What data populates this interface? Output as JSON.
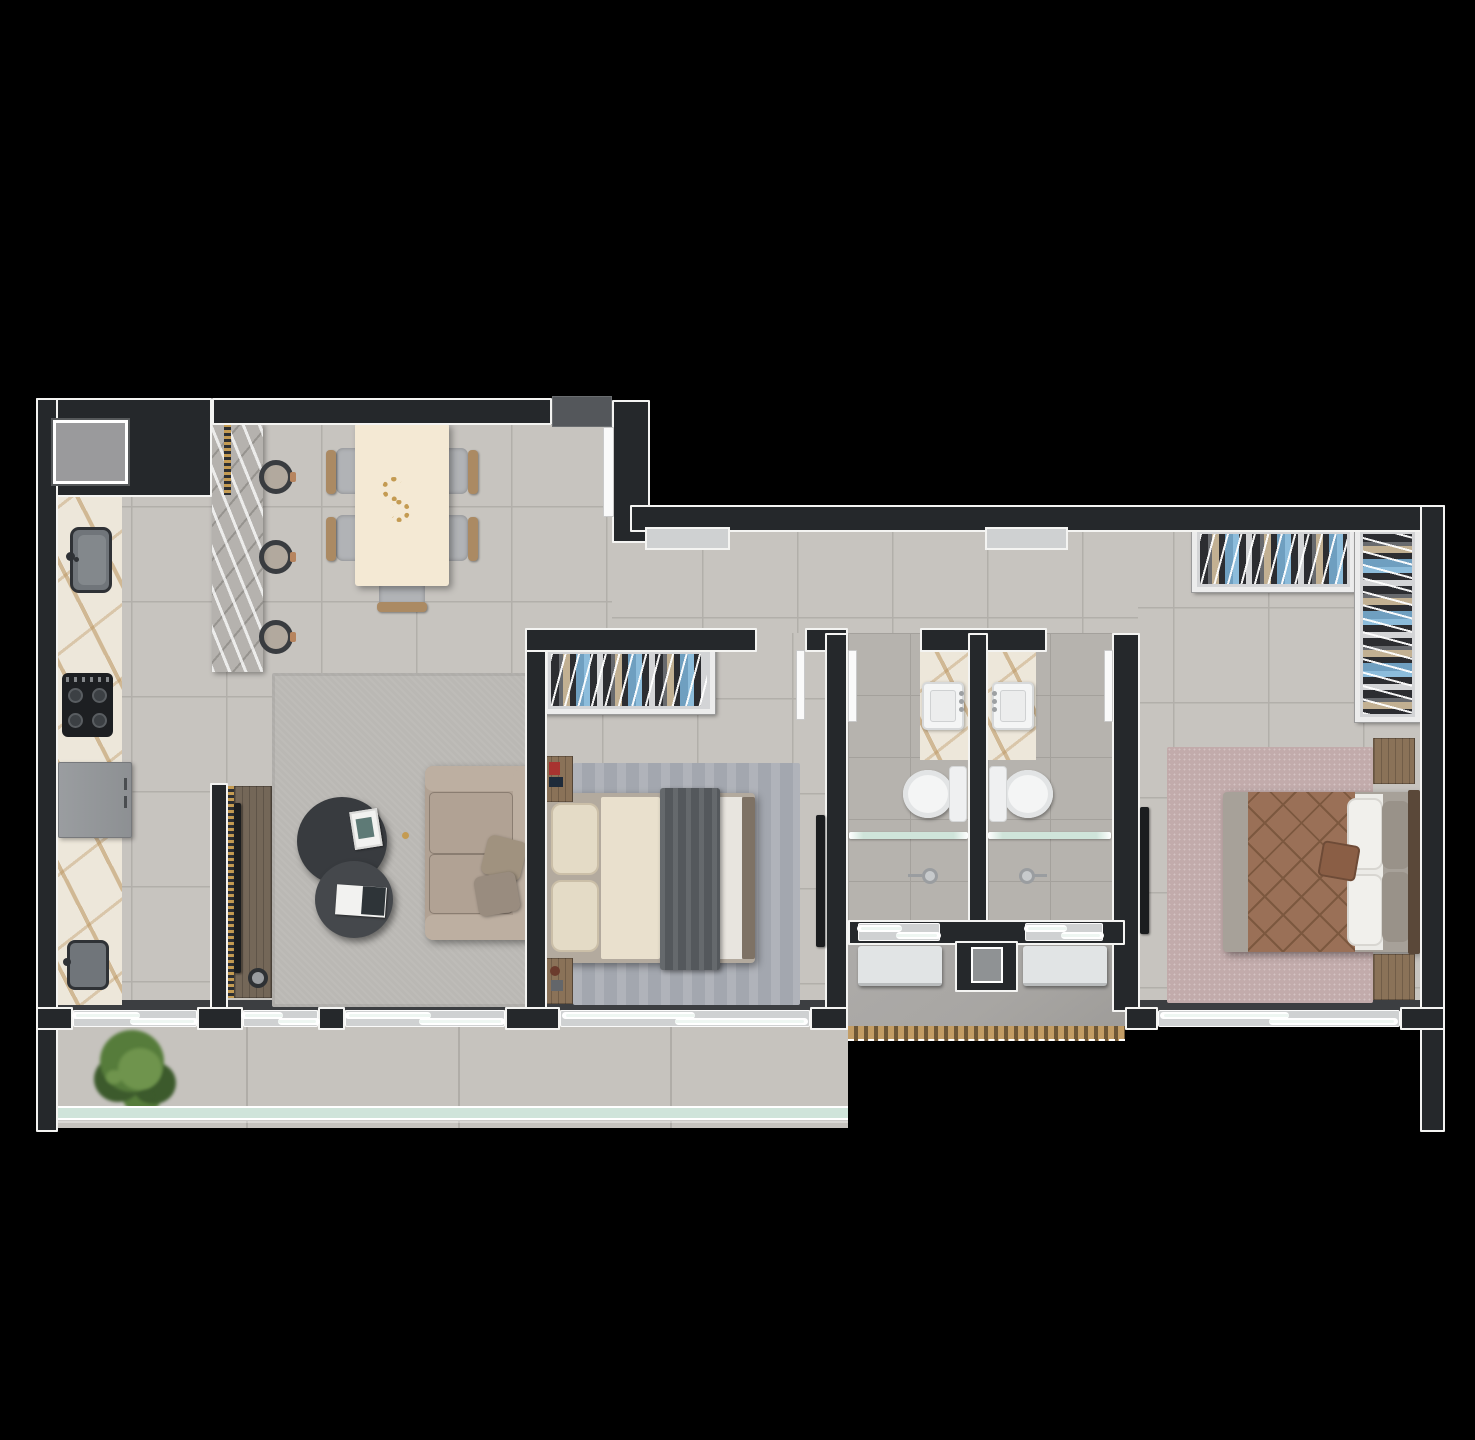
{
  "scene": {
    "type": "apartment-floor-plan-3d-render",
    "view": "top-down",
    "background": "#000000",
    "note": "photoreal furnished floor plan, no text labels visible"
  },
  "palette": {
    "bg": "#000000",
    "wall": "#25282b",
    "trim": "#f4f4f2",
    "floorMain": "#c7c4bf",
    "groutMain": "#b2afaa",
    "floorBath": "#b6b3ae",
    "groutBath": "#a4a19c",
    "floorService": "#a8a6a3",
    "floorBalcony": "#c6c3be",
    "groutBalcony": "#b0ada8",
    "track": "#3c3e41",
    "marbleCream": "#ede7da",
    "marbleGray": "#b5b2ae",
    "tableCream": "#f4e9d4",
    "woodMid": "#8a7258",
    "consoleWood": "#746758",
    "sofaBody": "#b1a294",
    "sofaArm": "#bdafa1",
    "sofaPillow": "#a0927f",
    "ctDark1": "#383b3f",
    "ctDark2": "#45484c",
    "rugLiving": "#bab8b4",
    "rugBed1": "#a3a7af",
    "rugBed2": "#c2abab",
    "sheetCream": "#e9e0cd",
    "pillowCream": "#e4dbc6",
    "blanketDark": "#54585c",
    "foldWhite": "#e8e5df",
    "bedBase1": "#b3aa9e",
    "bedEdge1": "#7e7265",
    "quiltBrown": "#9a7057",
    "quiltSeam": "#7c583f",
    "bedBase2": "#a7a199",
    "sheetWhite2": "#ecebe7",
    "pillowGray2": "#999289",
    "headboard2": "#5a4839",
    "cushionBrown": "#8a5e45",
    "clothDark": "#2c2d31",
    "clothBlue": "#6f9fc0",
    "clothBlueLt": "#8cbcdb",
    "clothTan": "#c2b092",
    "closetBase": "#d3d4d6",
    "closetFrame": "#ececec",
    "fixtureWhite": "#f4f5f5",
    "fixtureShade": "#d7d9da",
    "applianceGray": "#94979a",
    "stoveBlack": "#1d1f22",
    "sinkSteel": "#70757a",
    "sinkDarkRim": "#2f3236",
    "acWhite": "#e1e4e5",
    "deckWood": "#c39d65",
    "deckGap": "#6e5736",
    "glassLine": "#eef6f2",
    "railTeal": "#cfe4da",
    "plantDark": "#3c5a2c",
    "plantMid": "#567c3b",
    "plantLight": "#6f944d",
    "landing": "#54575b",
    "brick": "#8c7e69",
    "steelGray": "#85888b",
    "goldTrim": "#c49b52",
    "tvBlack": "#1b1d1f",
    "doorLeaf": "#fafafa",
    "sillGray": "#cfd1d2",
    "nicheGray": "#8f9294",
    "bookWhite": "#f2f2f0"
  },
  "rooms": {
    "kitchen": {
      "name": "Kitchen",
      "items": [
        "gold-veined marble counter",
        "steel sink",
        "gas cooktop",
        "refrigerator",
        "second prep sink",
        "brick barbecue niche",
        "utility shaft",
        "gray marble island",
        "three bar stools"
      ]
    },
    "dining": {
      "name": "Dining area",
      "items": [
        "cream dining table",
        "five gray-and-wood chairs",
        "gold beaded centerpiece"
      ]
    },
    "living": {
      "name": "Living room",
      "items": [
        "gray rug",
        "taupe three-seat sofa",
        "two charcoal round coffee tables",
        "open book",
        "magazine",
        "wood TV console with studded trim",
        "wall TV",
        "round speaker"
      ]
    },
    "hallway": {
      "name": "Entry hall and corridor",
      "items": [
        "entry door with landing",
        "two corridor windows"
      ]
    },
    "bedroom1": {
      "name": "Bedroom 1",
      "items": [
        "wardrobe with hanging clothes",
        "double bed with dark throw",
        "two nightstands",
        "blue-gray rug",
        "wall-mounted TV",
        "sliding balcony window"
      ]
    },
    "bathroom1": {
      "name": "Bathroom 1",
      "items": [
        "marble vanity mat",
        "square sink",
        "toilet",
        "glass shower partition",
        "shower head",
        "window"
      ]
    },
    "bathroom2": {
      "name": "Bathroom 2",
      "items": [
        "marble vanity mat",
        "square sink",
        "toilet",
        "glass shower partition",
        "shower head",
        "window"
      ]
    },
    "bedroom2": {
      "name": "Bedroom 2",
      "items": [
        "L-shaped wardrobe with hanging clothes",
        "double bed with leather quilt",
        "two wood nightstands",
        "mauve rug",
        "wall-mounted TV",
        "sliding window"
      ]
    },
    "service": {
      "name": "Service area",
      "items": [
        "two AC condenser units",
        "utility niche",
        "wood deck edge"
      ]
    },
    "balcony": {
      "name": "Balcony terrace",
      "items": [
        "potted plant",
        "tiled deck",
        "teal glass railing",
        "sliding glass doors"
      ]
    }
  }
}
